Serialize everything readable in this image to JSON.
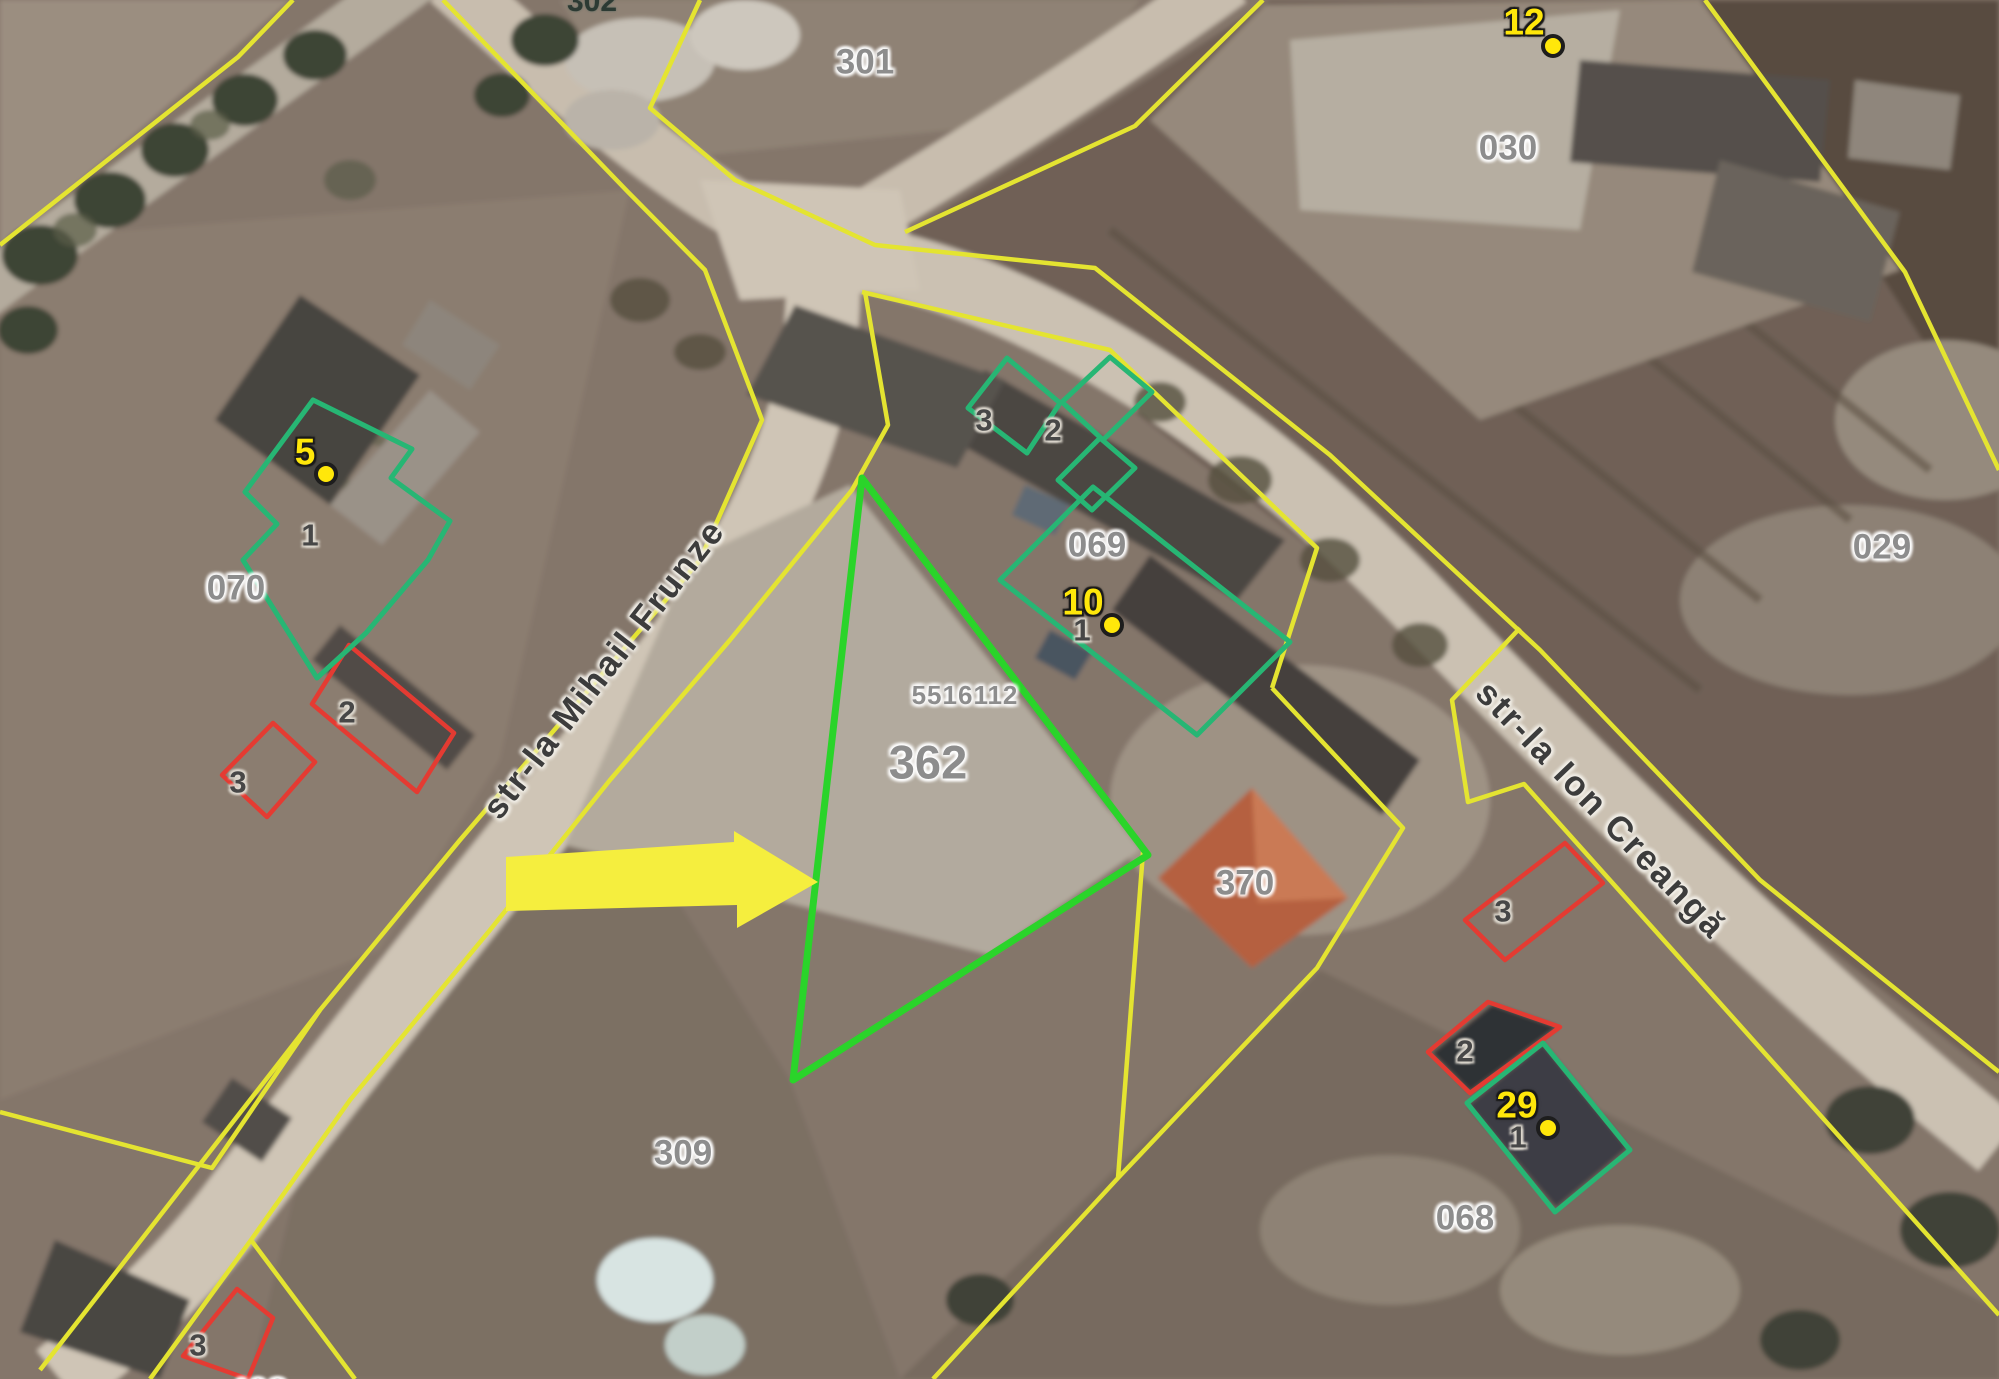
{
  "app": {
    "type": "cadastral-map-viewer"
  },
  "colors": {
    "parcel-line": "#e4e431",
    "building-line": "#27b674",
    "selected-line": "#2ad42a",
    "red-line": "#e43b32",
    "arrow": "#f5ee3e",
    "addr": "#ffe70a",
    "parcel-label": "#8d8d8d",
    "street-label": "#3c3c3c",
    "bldg-label": "#474747"
  },
  "selected_parcel": {
    "cadastral_id": "5516112",
    "number": "362"
  },
  "streets": [
    {
      "name": "str-la Mihail Frunze",
      "x": 604,
      "y": 669,
      "rotation": -52
    },
    {
      "name": "str-la Ion Creangă",
      "x": 1601,
      "y": 810,
      "rotation": 46
    }
  ],
  "parcels": [
    {
      "number": "301",
      "x": 865,
      "y": 62,
      "kind": "parcel"
    },
    {
      "number": "302",
      "x": 592,
      "y": 2,
      "kind": "dark"
    },
    {
      "number": "030",
      "x": 1508,
      "y": 148,
      "kind": "parcel"
    },
    {
      "number": "029",
      "x": 1882,
      "y": 547,
      "kind": "parcel"
    },
    {
      "number": "070",
      "x": 236,
      "y": 588,
      "kind": "parcel"
    },
    {
      "number": "069",
      "x": 1097,
      "y": 545,
      "kind": "parcel"
    },
    {
      "number": "5516112",
      "x": 965,
      "y": 695,
      "kind": "cadastral-id"
    },
    {
      "number": "362",
      "x": 928,
      "y": 762,
      "kind": "selected"
    },
    {
      "number": "370",
      "x": 1245,
      "y": 883,
      "kind": "parcel"
    },
    {
      "number": "309",
      "x": 683,
      "y": 1153,
      "kind": "parcel"
    },
    {
      "number": "068",
      "x": 1465,
      "y": 1218,
      "kind": "parcel"
    },
    {
      "number": "408",
      "x": 258,
      "y": 1392,
      "kind": "parcel"
    }
  ],
  "buildings": [
    {
      "number": "1",
      "x": 310,
      "y": 535
    },
    {
      "number": "2",
      "x": 347,
      "y": 712
    },
    {
      "number": "3",
      "x": 238,
      "y": 782
    },
    {
      "number": "3",
      "x": 984,
      "y": 420
    },
    {
      "number": "2",
      "x": 1053,
      "y": 430
    },
    {
      "number": "1",
      "x": 1082,
      "y": 630
    },
    {
      "number": "3",
      "x": 1503,
      "y": 911
    },
    {
      "number": "2",
      "x": 1465,
      "y": 1051
    },
    {
      "number": "1",
      "x": 1518,
      "y": 1137
    },
    {
      "number": "3",
      "x": 198,
      "y": 1345
    }
  ],
  "address_points": [
    {
      "number": "5",
      "label_x": 305,
      "label_y": 452,
      "dot_x": 326,
      "dot_y": 474
    },
    {
      "number": "10",
      "label_x": 1083,
      "label_y": 602,
      "dot_x": 1112,
      "dot_y": 625
    },
    {
      "number": "12",
      "label_x": 1524,
      "label_y": 22,
      "dot_x": 1553,
      "dot_y": 46
    },
    {
      "number": "29",
      "label_x": 1517,
      "label_y": 1105,
      "dot_x": 1548,
      "dot_y": 1128
    }
  ]
}
